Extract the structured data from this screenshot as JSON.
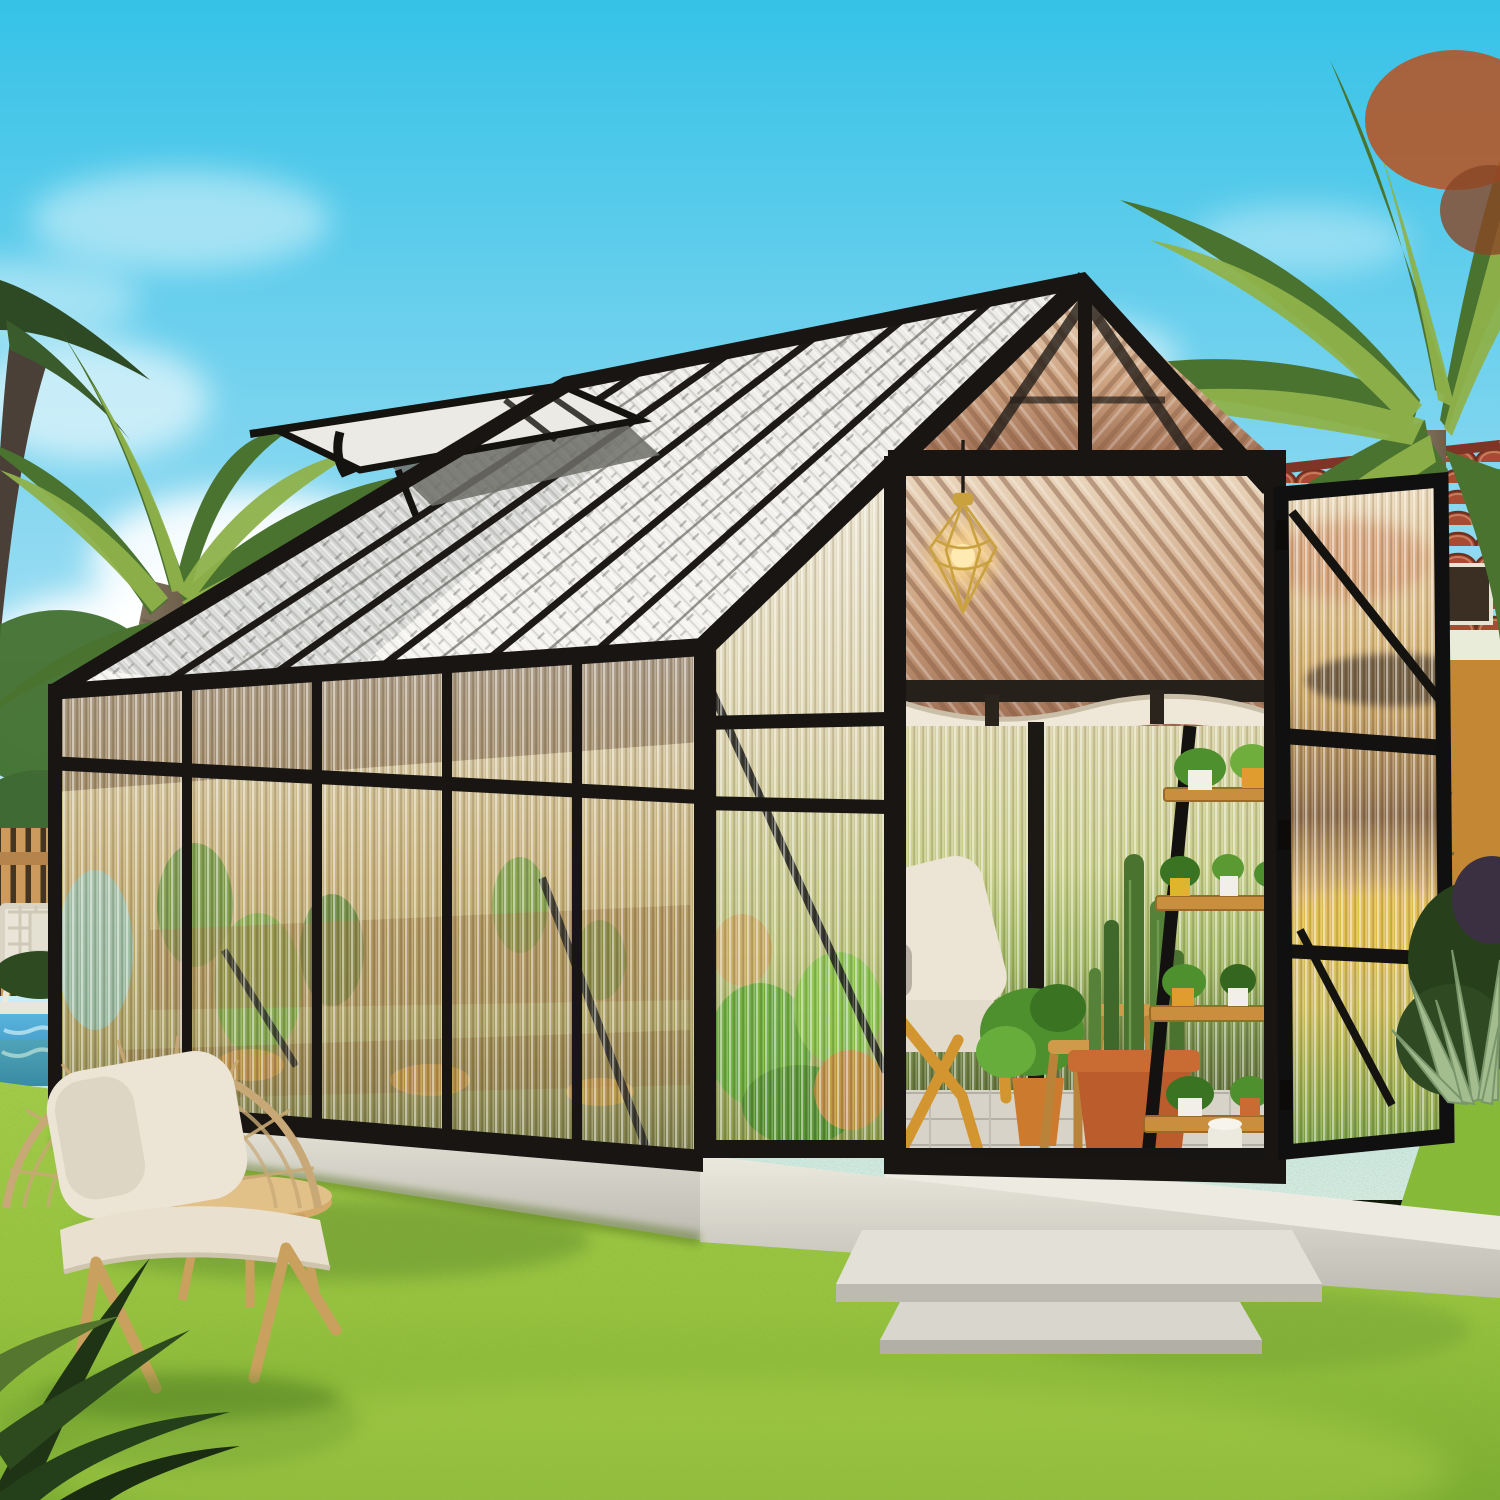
{
  "scene": {
    "type": "product-photograph",
    "setting": "sunny backyard garden with lawn, pool corner and palm trees",
    "subject": "walk-in gable greenhouse with black aluminum frame and fluted polycarbonate panels",
    "objects": [
      "blue sky with cumulus clouds",
      "left date palm with red fruit clusters",
      "dark palm silhouette at far left edge",
      "leafy background tree",
      "wooden picket fence",
      "white folding chairs",
      "swimming pool corner",
      "greenhouse with open roof vent",
      "open double-door gable entrance",
      "hanging cage pendant lamp",
      "rolled white shade inside eave",
      "interior lounge chair",
      "potted plants and cacti in terracotta pots",
      "ladder plant shelf with pots",
      "concrete foundation slab and step pads",
      "yellow stucco house with red clay tile roof",
      "right palm tree",
      "agave plants",
      "rattan wicker chair with cushions",
      "round wooden side table",
      "green lawn"
    ]
  },
  "palette": {
    "sky_top": "#35c2e7",
    "sky_horizon": "#e3f4fb",
    "cloud": "#ffffff",
    "grass_light": "#a9d04a",
    "grass_deep": "#7fae2f",
    "frame_black": "#181512",
    "roof_panel": "#e7e6e2",
    "panel_warm": "#c4ad74",
    "door_glass": "#cfa964",
    "concrete": "#dcdad1",
    "terracotta": "#bb5c2d",
    "pool_water": "#59b4dc",
    "fence_wood": "#cd9a5e",
    "building_wall": "#eea93f",
    "building_roof": "#a84b33",
    "palm_light": "#8fb24a",
    "palm_dark": "#4a7330",
    "palm_trunk": "#86765f",
    "date_fruit": "#b8511f",
    "agave": "#a3bd8e",
    "lamp_glow": "#ffe3a1",
    "shade_fabric": "#efe8d8",
    "cushion": "#ece4d4",
    "wicker": "#c8a876",
    "interior_wood": "#d3952f",
    "plant_green": "#4e8f2e",
    "floor_paver": "#d8d3c9"
  }
}
